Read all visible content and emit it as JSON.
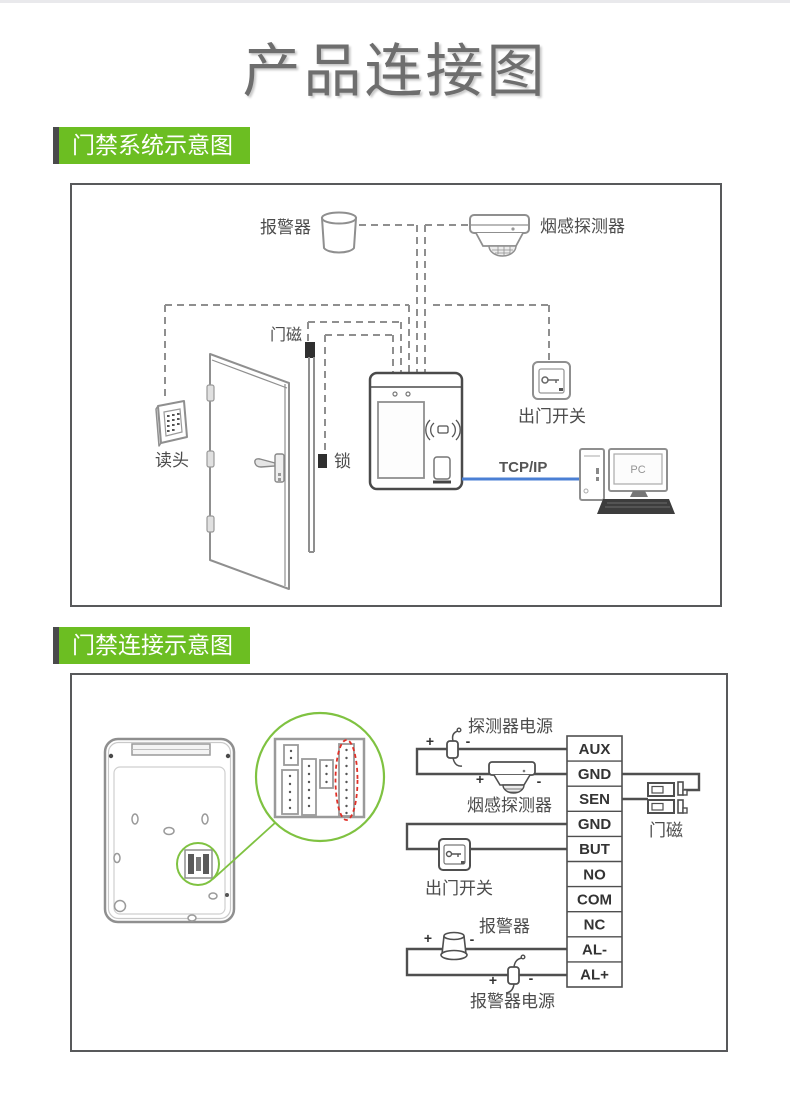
{
  "page": {
    "title": "产品连接图"
  },
  "section1": {
    "heading": "门禁系统示意图",
    "labels": {
      "alarm": "报警器",
      "smoke_detector": "烟感探测器",
      "door_magnet": "门磁",
      "reader": "读头",
      "lock": "锁",
      "exit_switch": "出门开关",
      "tcpip": "TCP/IP",
      "pc": "PC"
    }
  },
  "section2": {
    "heading": "门禁连接示意图",
    "labels": {
      "detector_power": "探测器电源",
      "smoke_detector": "烟感探测器",
      "exit_switch": "出门开关",
      "alarm": "报警器",
      "alarm_power": "报警器电源",
      "door_magnet": "门磁",
      "plus": "+",
      "minus": "-"
    },
    "terminals": [
      "AUX",
      "GND",
      "SEN",
      "GND",
      "BUT",
      "NO",
      "COM",
      "NC",
      "AL-",
      "AL+"
    ]
  },
  "colors": {
    "accent_green": "#6cbe22",
    "circle_green": "#7fc241",
    "wire_blue": "#4a7fd4",
    "highlight_red": "#e03028",
    "diagram_gray": "#8f8f8f"
  }
}
